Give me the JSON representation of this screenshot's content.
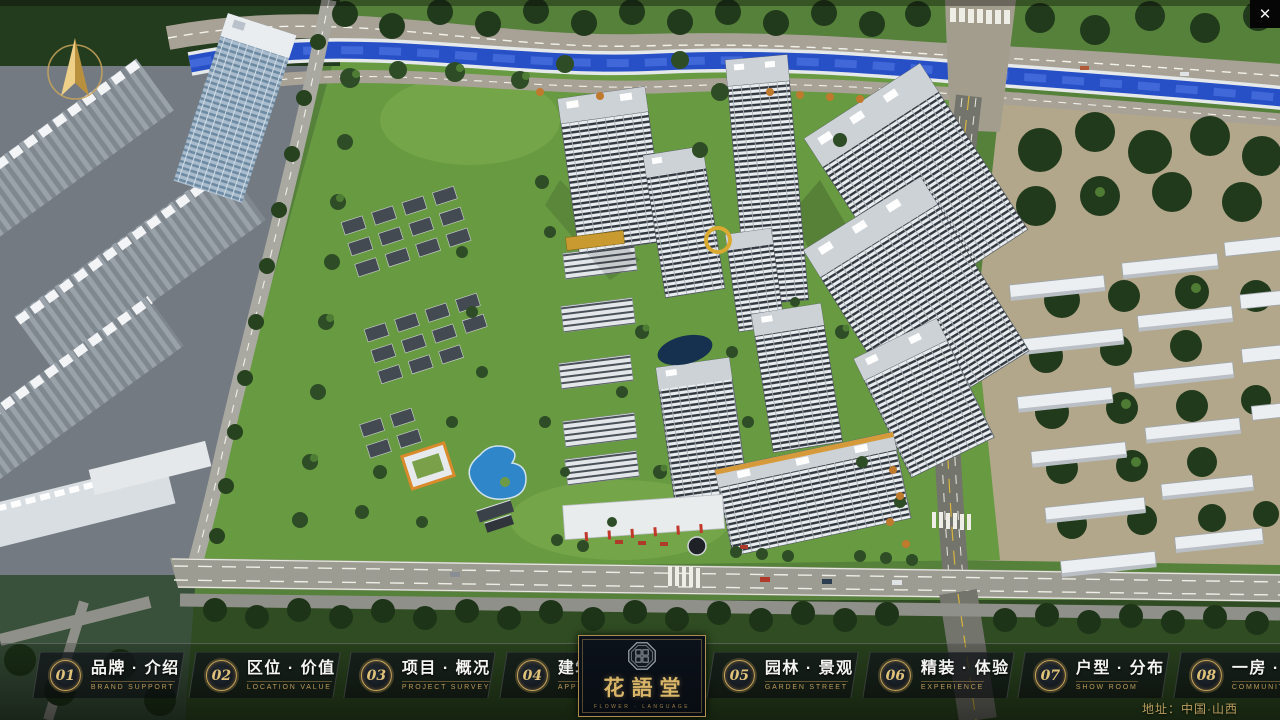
{
  "chrome": {
    "close_glyph": "✕"
  },
  "icons": {
    "compass": "north-compass-arrow",
    "close": "close-x",
    "seal": "octagonal-brand-seal"
  },
  "nav": {
    "items": [
      {
        "num": "01",
        "zh": "品牌 · 介绍",
        "en": "BRAND SUPPORT"
      },
      {
        "num": "02",
        "zh": "区位 · 价值",
        "en": "LOCATION VALUE"
      },
      {
        "num": "03",
        "zh": "项目 · 概况",
        "en": "PROJECT SURVEY"
      },
      {
        "num": "04",
        "zh": "建筑 · 鉴赏",
        "en": "APPRECIATION"
      },
      {
        "num": "05",
        "zh": "园林 · 景观",
        "en": "GARDEN STREET"
      },
      {
        "num": "06",
        "zh": "精装 · 体验",
        "en": "EXPERIENCE"
      },
      {
        "num": "07",
        "zh": "户型 · 分布",
        "en": "SHOW ROOM"
      },
      {
        "num": "08",
        "zh": "一房 · 一景",
        "en": "COMMUNITY"
      }
    ]
  },
  "logo": {
    "title": "花語堂",
    "subtitle": "FLOWER · LANGUAGE"
  },
  "footer": {
    "address": "地址：中国·山西"
  },
  "colors": {
    "gold": "#c9a45a",
    "water": "#2a52c4",
    "lawn": "#679a41",
    "bar_bg": "rgba(10,13,17,0.7)"
  }
}
